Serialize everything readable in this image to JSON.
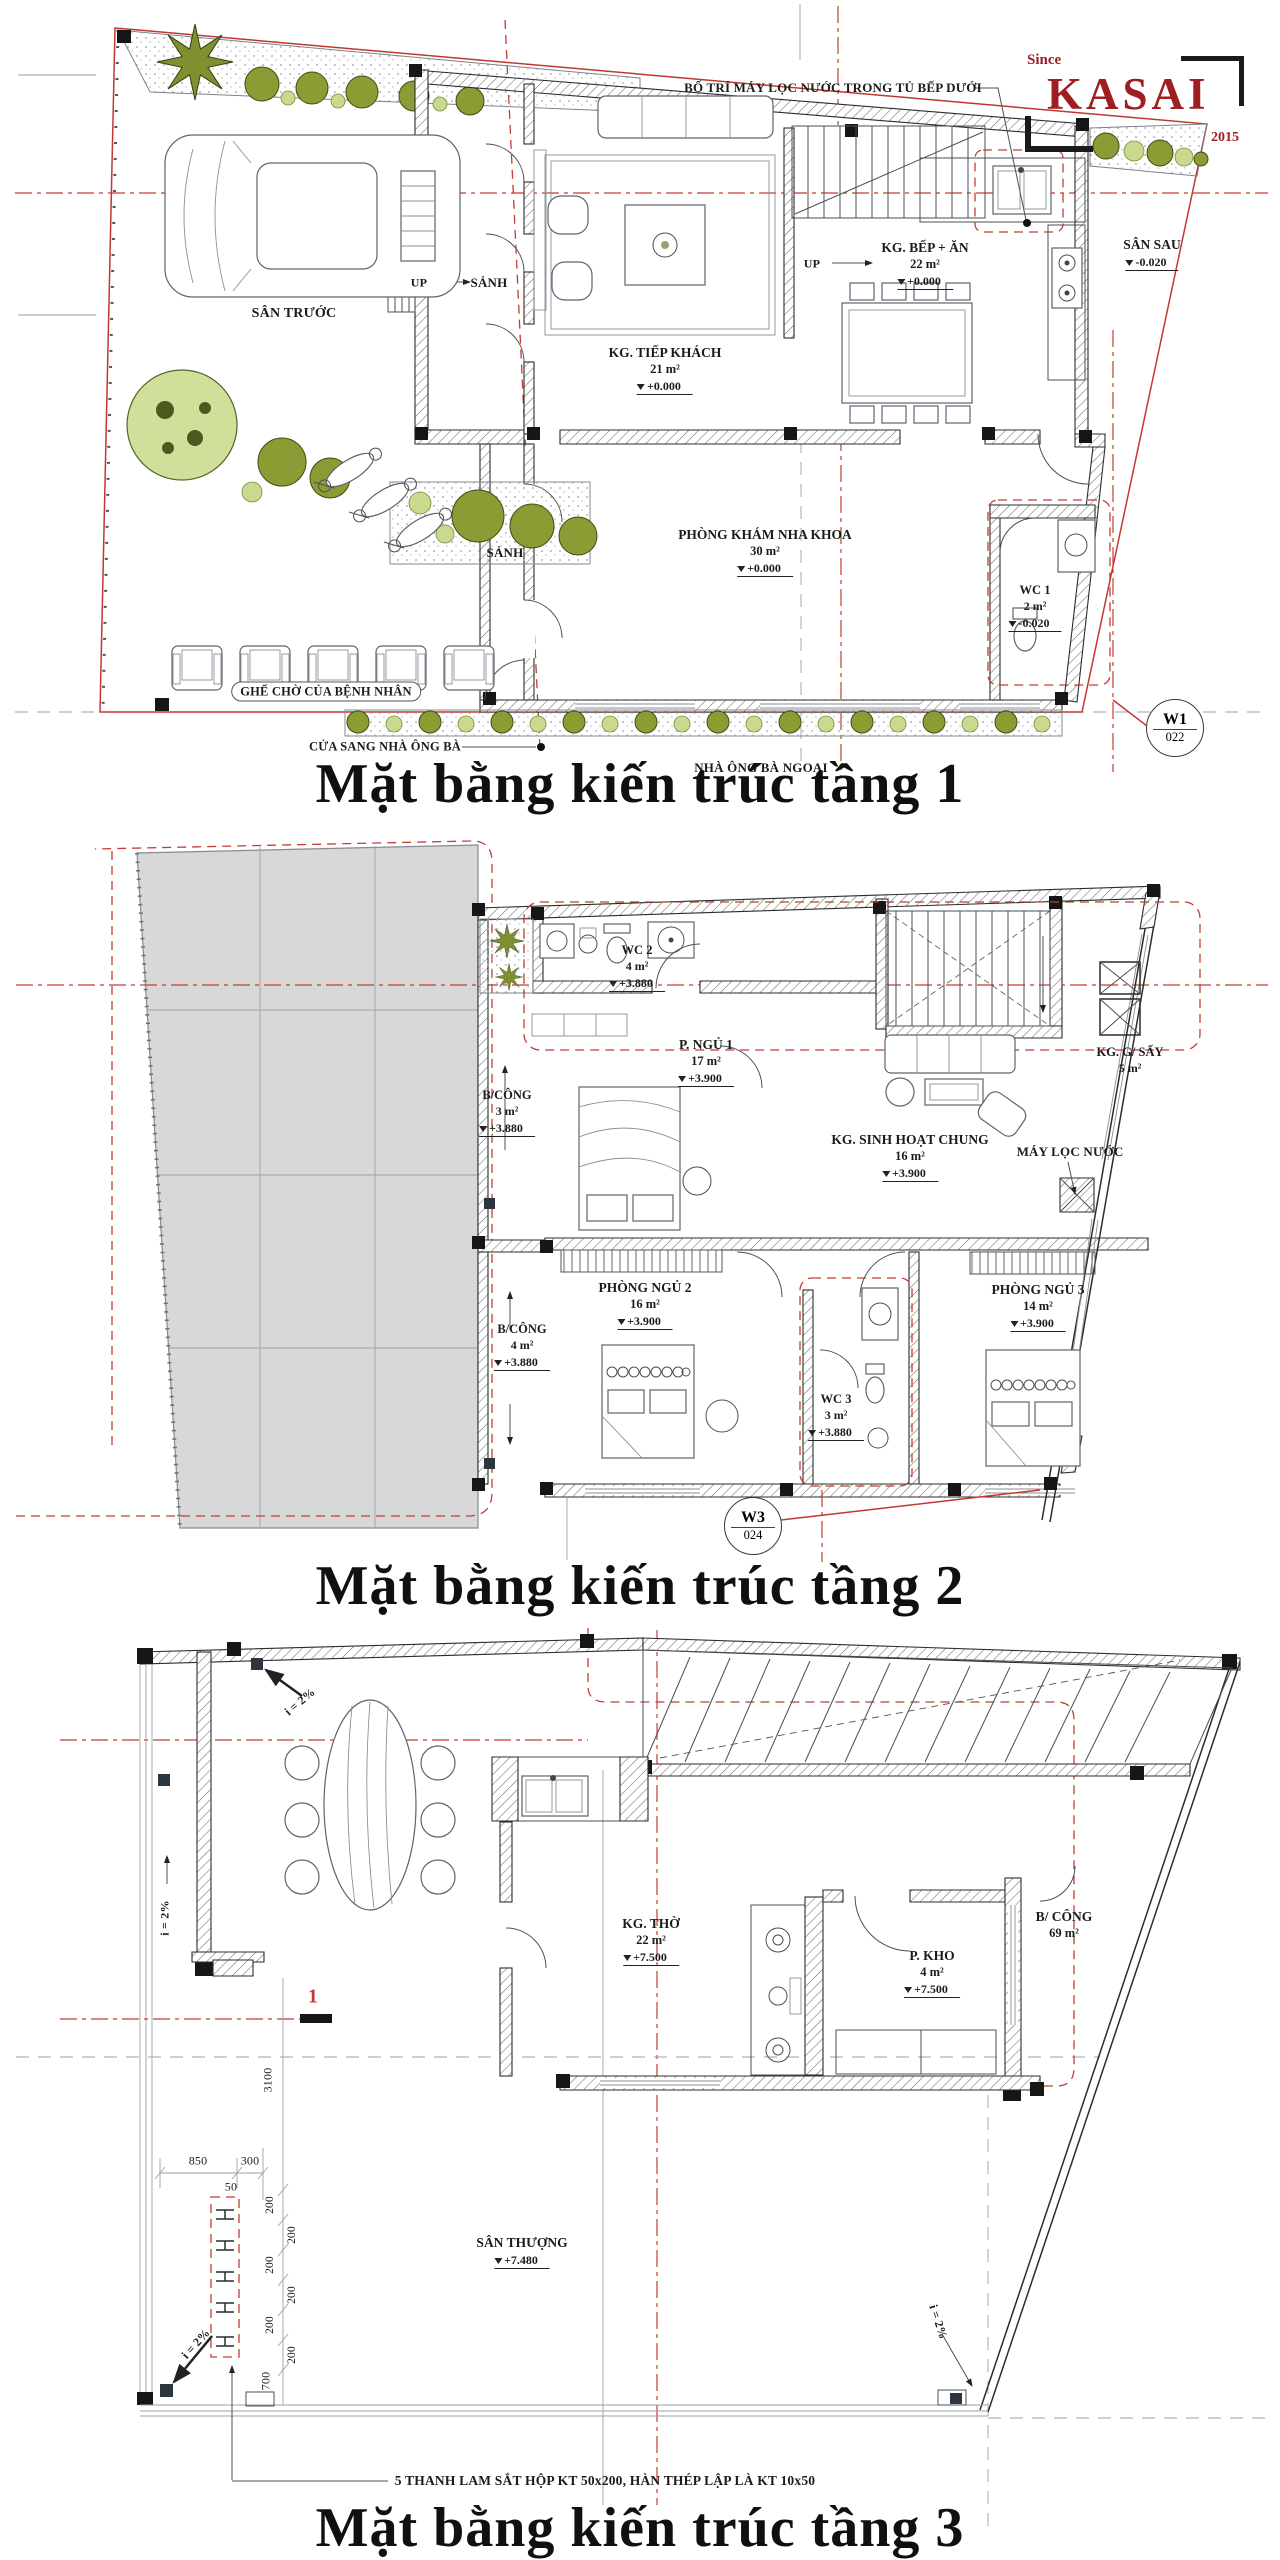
{
  "logo": {
    "since": "Since",
    "name": "KASAI",
    "year": "2015"
  },
  "titles": {
    "t1": "Mặt bằng kiến trúc tầng 1",
    "t2": "Mặt bằng kiến trúc tầng 2",
    "t3": "Mặt bằng kiến trúc tầng 3"
  },
  "f1": {
    "note_top": "BỐ TRÍ MÁY LỌC NƯỚC TRONG TỦ BẾP DƯỚI",
    "san_truoc": "SÂN TRƯỚC",
    "sanh": "SẢNH",
    "up": "UP",
    "tiep_khach": {
      "name": "KG. TIẾP KHÁCH",
      "area": "21 m²",
      "level": "+0.000"
    },
    "bep_an": {
      "name": "KG. BẾP + ĂN",
      "area": "22 m²",
      "level": "+0.000"
    },
    "san_sau": {
      "name": "SÂN SAU",
      "level": "-0.020"
    },
    "kham": {
      "name": "PHÒNG KHÁM NHA KHOA",
      "area": "30 m²",
      "level": "+0.000"
    },
    "wc1": {
      "name": "WC 1",
      "area": "2 m²",
      "level": "-0.020"
    },
    "ghe_cho": "GHẾ CHỜ CỦA BỆNH NHÂN",
    "cua_sang": "CỬA SANG NHÀ ÔNG BÀ",
    "nha_ong_ba": "NHÀ ÔNG BÀ NGOẠI",
    "marker": {
      "code": "W1",
      "sheet": "022"
    }
  },
  "f2": {
    "wc2": {
      "name": "WC 2",
      "area": "4 m²",
      "level": "+3.880"
    },
    "ngu1": {
      "name": "P. NGỦ 1",
      "area": "17 m²",
      "level": "+3.900"
    },
    "bcong3": {
      "name": "B/CÔNG",
      "area": "3 m²",
      "level": "+3.880"
    },
    "shc": {
      "name": "KG. SINH HOẠT CHUNG",
      "area": "16 m²",
      "level": "+3.900"
    },
    "gsay": {
      "name": "KG. G/ SẤY",
      "area": "5 m²"
    },
    "mayloc": "MÁY LỌC NƯỚC",
    "ngu2": {
      "name": "PHÒNG NGỦ 2",
      "area": "16 m²",
      "level": "+3.900"
    },
    "ngu3": {
      "name": "PHÒNG NGỦ 3",
      "area": "14 m²",
      "level": "+3.900"
    },
    "wc3": {
      "name": "WC 3",
      "area": "3 m²",
      "level": "+3.880"
    },
    "bcong4": {
      "name": "B/CÔNG",
      "area": "4 m²",
      "level": "+3.880"
    },
    "marker": {
      "code": "W3",
      "sheet": "024"
    }
  },
  "f3": {
    "tho": {
      "name": "KG. THỜ",
      "area": "22 m²",
      "level": "+7.500"
    },
    "kho": {
      "name": "P. KHO",
      "area": "4 m²",
      "level": "+7.500"
    },
    "bcong": {
      "name": "B/ CÔNG",
      "area": "69 m²"
    },
    "santhuong": {
      "name": "SÂN THƯỢNG",
      "level": "+7.480"
    },
    "slope": "i = 2%",
    "sec": "1",
    "d850": "850",
    "d300": "300",
    "d50": "50",
    "d3100": "3100",
    "d700": "700",
    "d200": "200",
    "note": "5 THANH LAM SẮT HỘP KT 50x200, HÀN THÉP LẬP LÀ KT 10x50"
  }
}
